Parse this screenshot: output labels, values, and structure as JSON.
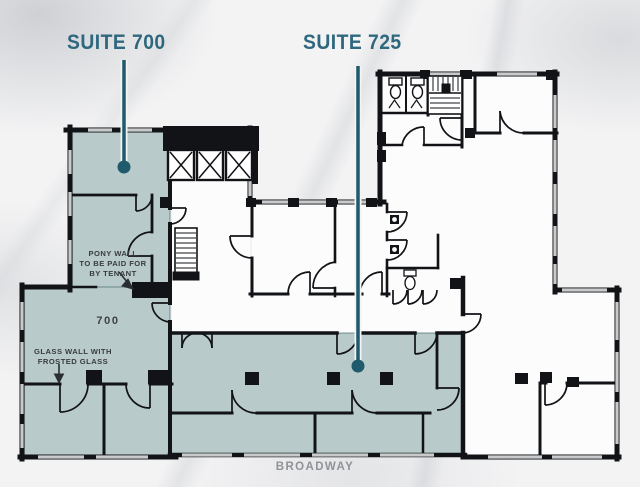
{
  "suites": {
    "suite700": {
      "label": "SUITE 700"
    },
    "suite725": {
      "label": "SUITE 725"
    }
  },
  "annotations": {
    "pony_wall_note": "PONY WALL\nTO BE PAID FOR\nBY TENANT",
    "room_number": "700",
    "glass_wall_note": "GLASS WALL WITH\nFROSTED GLASS",
    "street_label": "BROADWAY"
  },
  "colors": {
    "label_teal": "#2f687e",
    "leader_teal": "#1f5a6d",
    "suite_fill": "#b8cac9",
    "wall_black": "#121316",
    "window_gray": "#c9cacc",
    "street_gray": "#909296",
    "background": "#f3f3f4"
  }
}
